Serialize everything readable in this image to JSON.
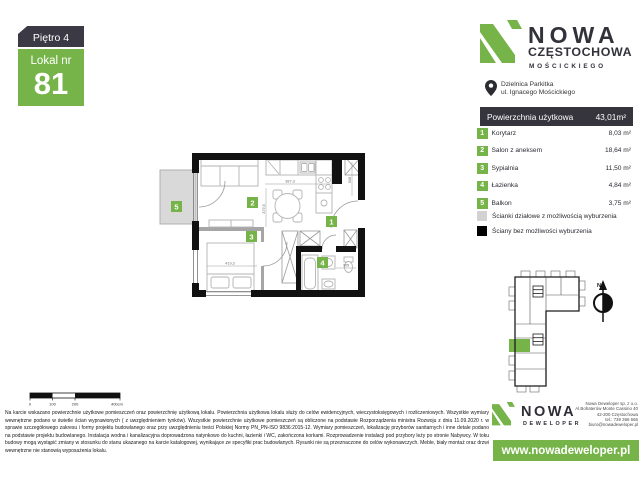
{
  "page": {
    "floor_badge": "Piętro 4",
    "unit_label": "Lokal nr",
    "unit_number": "81"
  },
  "brand": {
    "name_line1": "NOWA",
    "name_line2": "CZĘSTOCHOWA",
    "name_line3": "MOŚCICKIEGO",
    "location_line1": "Dzielnica Parkitka",
    "location_line2": "ul. Ignacego Mościckiego"
  },
  "area_table": {
    "header_label": "Powierzchnia użytkowa",
    "header_value": "43,01m²",
    "rows": [
      {
        "num": "1",
        "label": "Korytarz",
        "value": "8,03 m²"
      },
      {
        "num": "2",
        "label": "Salon z aneksem",
        "value": "18,64 m²"
      },
      {
        "num": "3",
        "label": "Sypialnia",
        "value": "11,50 m²"
      },
      {
        "num": "4",
        "label": "Łazienka",
        "value": "4,84 m²"
      },
      {
        "num": "5",
        "label": "Balkon",
        "value": "3,75 m²"
      }
    ]
  },
  "legend": {
    "partition_label": "Ścianki działowe z możliwością wyburzenia",
    "solid_label": "Ściany bez możliwości wyburzenia"
  },
  "floorplan": {
    "room_numbers": [
      "1",
      "2",
      "3",
      "4",
      "5"
    ],
    "dimensions": {
      "salon_width": "387,3",
      "salon_height": "379,5",
      "bedroom_width": "419,3",
      "hall_height": "508",
      "bath_width": "305"
    }
  },
  "keyplan": {
    "north_label": "N"
  },
  "scalebar": {
    "t0": "0",
    "t1": "100",
    "t2": "200",
    "t3": "400cm"
  },
  "footer": {
    "disclaimer": "Na karcie wskazano powierzchnie użytkowe pomieszczeń oraz powierzchnię użytkową lokalu. Powierzchnia użytkowa lokalu służy do celów ewidencyjnych, wieczystoksięgowych i rozliczeniowych. Wszystkie wymiary wewnętrzne podano w świetle ścian wyprawionych ( z uwzględnieniem tynków). Wszystkie powierzchnie użytkowe pomieszczeń są obliczone na podstawie Rozporządzenia ministra Rozwoju z dnia 11.09.2020 r. w sprawie szczegółowego zakresu i formy projektu budowlanego oraz przy uwzględnieniu treści Polskiej Normy PN_PN-ISO 9836:2015-12. Wymiary pomieszczeń, lokalizację przyborów sanitarnych i inne detale podano na podstawie projektu budowlanego. Instalacja wodna i kanalizacyjna doprowadzona natynkowo do kuchni, łazienki i WC, zakończona korkami. Rozprowadzenie instalacji pod przybory leży po stronie Nabywcy. W toku budowy mogą wystąpić zmiany w stosunku do stanu ukazanego na karcie katalogowej, wynikające ze specyfiki prac budowlanych. Rysunki nie są przeznaczone do celów wykonawczych. Meble, biały montaż oraz drzwi wewnętrzne nie stanowią wyposażenia lokalu.",
    "brand_line1": "NOWA",
    "brand_line2": "DEWELOPER",
    "address_line1": "Nowa Deweloper sp. z o.o.",
    "address_line2": "Al.Bohaterów Monte Cassino 40",
    "address_line3": "42-200 Częstochowa",
    "address_line4": "tel.: 739 366 665",
    "address_line5": "biuro@nowadeweloper.pl",
    "website": "www.nowadeweloper.pl"
  },
  "colors": {
    "accent_green": "#76b449",
    "dark": "#36353e",
    "partition_gray": "#d2d2d2",
    "wall_black": "#111111"
  }
}
